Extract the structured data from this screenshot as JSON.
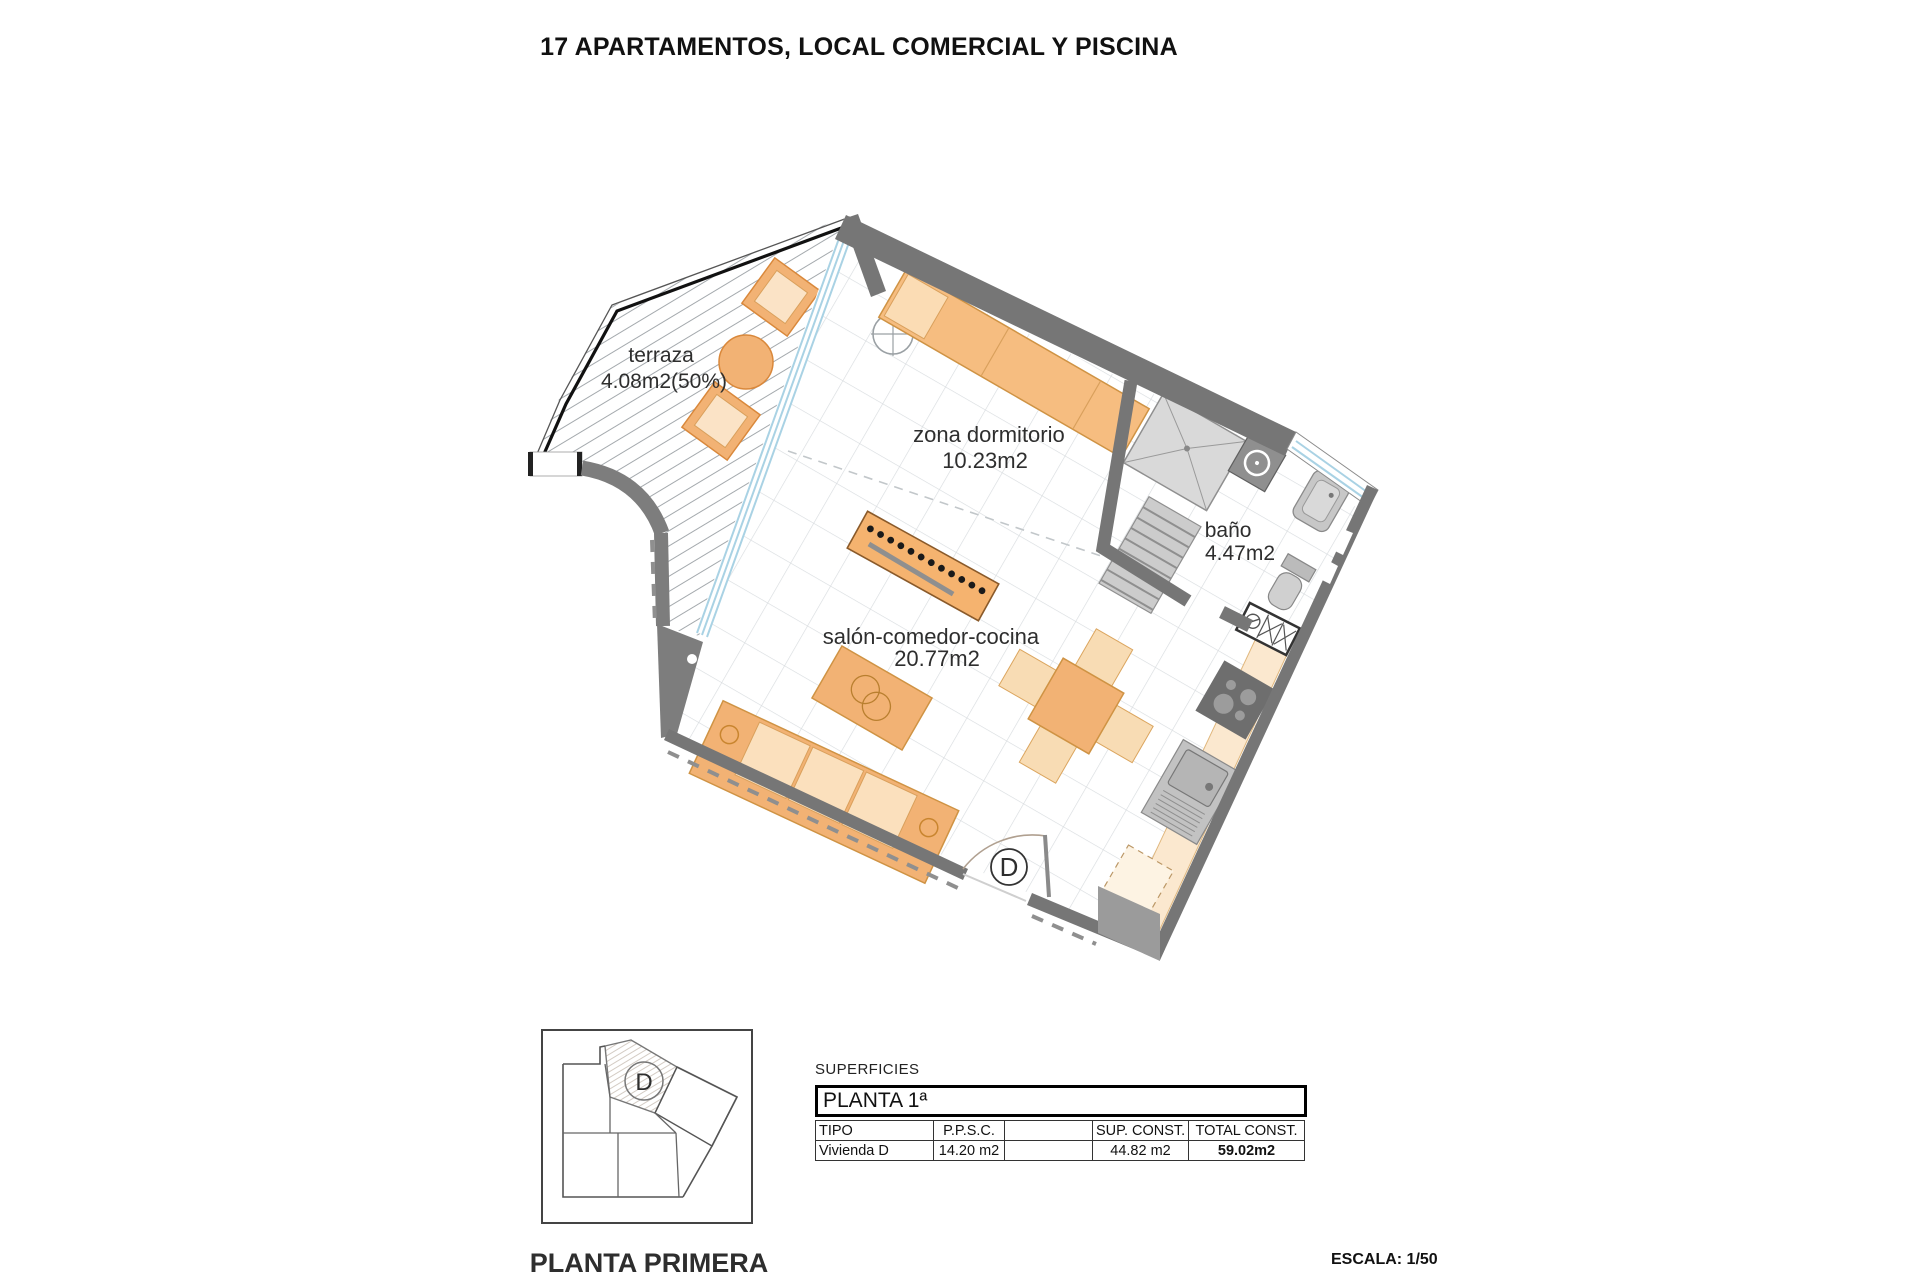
{
  "title": "17 APARTAMENTOS, LOCAL COMERCIAL Y PISCINA",
  "plan": {
    "rooms": [
      {
        "name": "terraza",
        "area": "4.08m2(50%)"
      },
      {
        "name": "zona dormitorio",
        "area": "10.23m2"
      },
      {
        "name": "baño",
        "area": "4.47m2"
      },
      {
        "name": "salón-comedor-cocina",
        "area": "20.77m2"
      }
    ],
    "unit_letter": "D"
  },
  "key_plan": {
    "unit_letter": "D",
    "caption": "PLANTA PRIMERA"
  },
  "surface_table": {
    "label": "SUPERFICIES",
    "floor_header": "PLANTA 1ª",
    "columns": [
      "TIPO",
      "P.P.S.C.",
      "",
      "SUP. CONST.",
      "TOTAL CONST."
    ],
    "rows": [
      [
        "Vivienda D",
        "14.20 m2",
        "",
        "44.82 m2",
        "59.02m2"
      ]
    ]
  },
  "scale_note": "ESCALA: 1/50",
  "colors": {
    "wall_gray": "#767676",
    "light_fixture_gray": "#c9c9c9",
    "furniture_orange": "#f2b274",
    "furniture_light": "#fbe0bd",
    "counter_cream": "#fbe8cf",
    "glazing_blue": "#a9d2e4",
    "tile_line": "#d8dcdf"
  }
}
